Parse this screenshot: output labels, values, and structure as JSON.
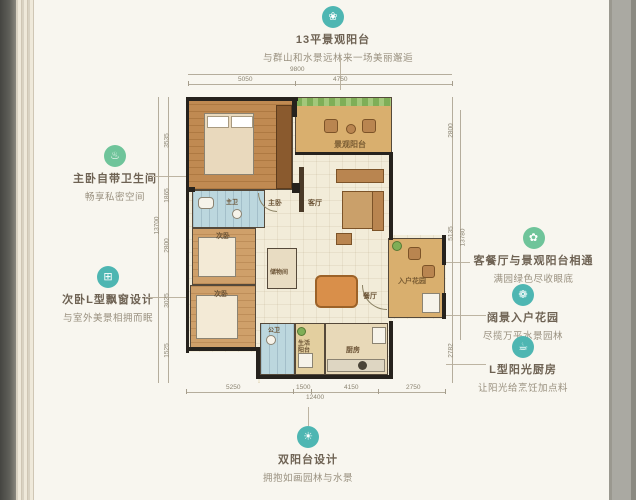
{
  "annotations": {
    "top": {
      "icon_glyph": "❀",
      "title": "13平景观阳台",
      "subtitle": "与群山和水景远林来一场美丽邂逅",
      "icon_color": "#4eb6b2"
    },
    "master_bath": {
      "icon_glyph": "♨",
      "title": "主卧自带卫生间",
      "subtitle": "畅享私密空间",
      "icon_color": "#6fc49a"
    },
    "bay_window": {
      "icon_glyph": "⊞",
      "title": "次卧L型飘窗设计",
      "subtitle": "与室外美景相拥而眠",
      "icon_color": "#4eb6b2"
    },
    "living_balcony": {
      "icon_glyph": "✿",
      "title": "客餐厅与景观阳台相通",
      "subtitle": "满园绿色尽收眼底",
      "icon_color": "#6fc49a"
    },
    "entry_garden": {
      "icon_glyph": "❁",
      "title": "阔景入户花园",
      "subtitle": "尽揽万平水景园林",
      "icon_color": "#4eb6b2"
    },
    "kitchen": {
      "icon_glyph": "☕",
      "title": "L型阳光厨房",
      "subtitle": "让阳光给烹饪加点料",
      "icon_color": "#4eb6b2"
    },
    "double_balcony": {
      "icon_glyph": "☀",
      "title": "双阳台设计",
      "subtitle": "拥抱如画园林与水景",
      "icon_color": "#4eb6b2"
    }
  },
  "rooms": {
    "master_bedroom": "主卧",
    "master_bath": "主卫",
    "bedroom2": "次卧",
    "bedroom3": "次卧",
    "storage": "储物间",
    "living_room": "客厅",
    "dining_room": "餐厅",
    "kitchen": "厨房",
    "utility_balcony": "生活阳台",
    "view_balcony": "景观阳台",
    "entry_garden": "入户花园",
    "guest_bath": "公卫"
  },
  "dimensions": {
    "top_total": "9800",
    "top_segments": [
      "5050",
      "4750"
    ],
    "bottom_total": "12400",
    "bottom_segments": [
      "5250",
      "1500",
      "4150",
      "2750"
    ],
    "left_total": "13700",
    "left_segments": [
      "3535",
      "1865",
      "2800",
      "3025",
      "1525"
    ],
    "right_total": "13780",
    "right_segments": [
      "2800",
      "5135",
      "2782"
    ]
  },
  "colors": {
    "teal_icon": "#4eb6b2",
    "green_icon": "#6fc49a",
    "wood_floor": "#c08a52",
    "balcony_floor": "#d9af6e",
    "bath_tile": "#bcd7de",
    "wall": "#26221d",
    "page_bg": "#f8f6ef"
  }
}
